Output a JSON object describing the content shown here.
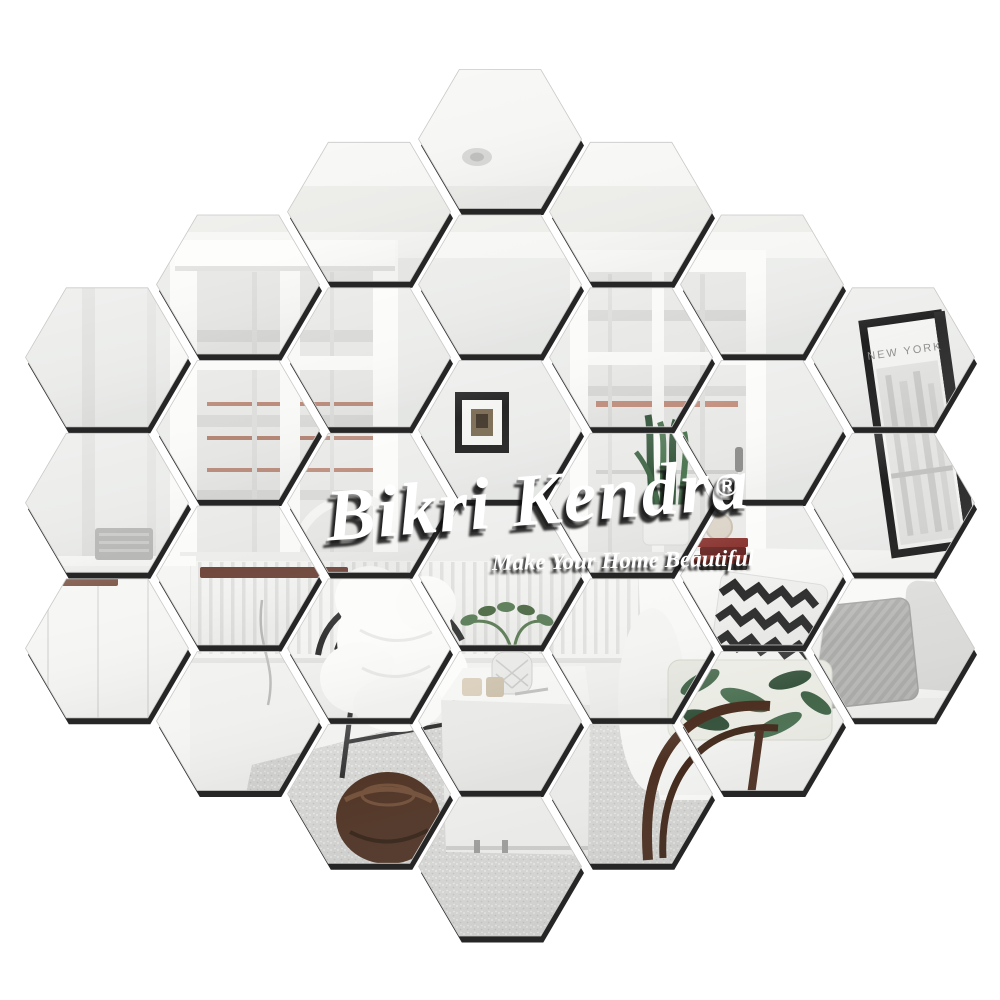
{
  "watermark": {
    "brand": "Bikri Kendra",
    "registered_mark": "®",
    "tagline": "Make Your Home Beautiful",
    "text_color": "#ffffff",
    "shadow_color": "#141414"
  },
  "scene": {
    "poster_text": "NEW YORK",
    "wall_color": "#ecedeb",
    "ceiling_color": "#f6f6f4",
    "floor_color": "#f0f0ee",
    "carpet_color": "#d3d3d1",
    "sofa_color": "#f8f8f6",
    "plant_green": "#2f5236",
    "book_red": "#842823",
    "pouf_brown": "#4a2d1d",
    "poster_frame": "#161616"
  },
  "product": {
    "name": "hexagonal-mirror-wall-stickers",
    "mirror_count": 30,
    "columns": [
      3,
      4,
      5,
      6,
      5,
      4,
      3
    ],
    "hex_width": 163,
    "hex_height": 139,
    "col_pitch": 131,
    "row_pitch": 145.5,
    "center_x": 500,
    "top_center_y": 139,
    "edge_shadow": "#141414",
    "mirror_stroke": "#c9c9c7",
    "gap_background": "#ffffff"
  }
}
